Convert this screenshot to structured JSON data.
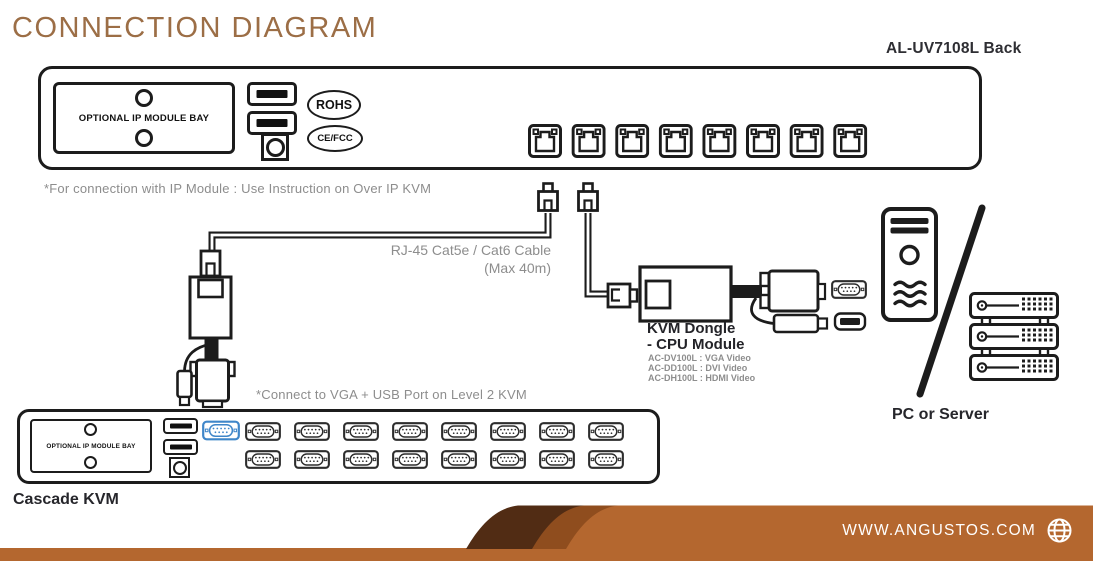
{
  "page": {
    "title": "CONNECTION DIAGRAM",
    "model_label": "AL-UV7108L Back"
  },
  "top_device": {
    "bay_label": "OPTIONAL IP MODULE BAY",
    "badges": [
      "ROHS",
      "CE/FCC"
    ],
    "usb_port_count": 2,
    "rj45_port_count": 8
  },
  "notes": {
    "ip_module": "*For connection with IP Module : Use Instruction on Over IP KVM",
    "cable_line1": "RJ-45 Cat5e / Cat6 Cable",
    "cable_line2": "(Max 40m)",
    "cascade_connect": "*Connect to VGA + USB Port on Level 2 KVM"
  },
  "dongle": {
    "title_line1": "KVM Dongle",
    "title_line2": "- CPU Module",
    "models": [
      "AC-DV100L : VGA Video",
      "AC-DD100L : DVI Video",
      "AC-DH100L : HDMI Video"
    ]
  },
  "pc_server": {
    "label": "PC or Server"
  },
  "cascade": {
    "label": "Cascade KVM",
    "bay_label": "OPTIONAL IP MODULE BAY",
    "top_row_ports": 9,
    "bottom_row_ports": 8,
    "highlighted_port_index": 0
  },
  "footer": {
    "website": "WWW.ANGUSTOS.COM"
  },
  "colors": {
    "title_brown": "#9c6e46",
    "note_gray": "#8d8d8d",
    "dark_text": "#26262c",
    "line_black": "#1c1c1c",
    "highlight_blue": "#3f86c9",
    "footer_orange": "#b4672f",
    "footer_medium_brown": "#8f4d1e",
    "footer_dark_brown": "#512c14"
  }
}
